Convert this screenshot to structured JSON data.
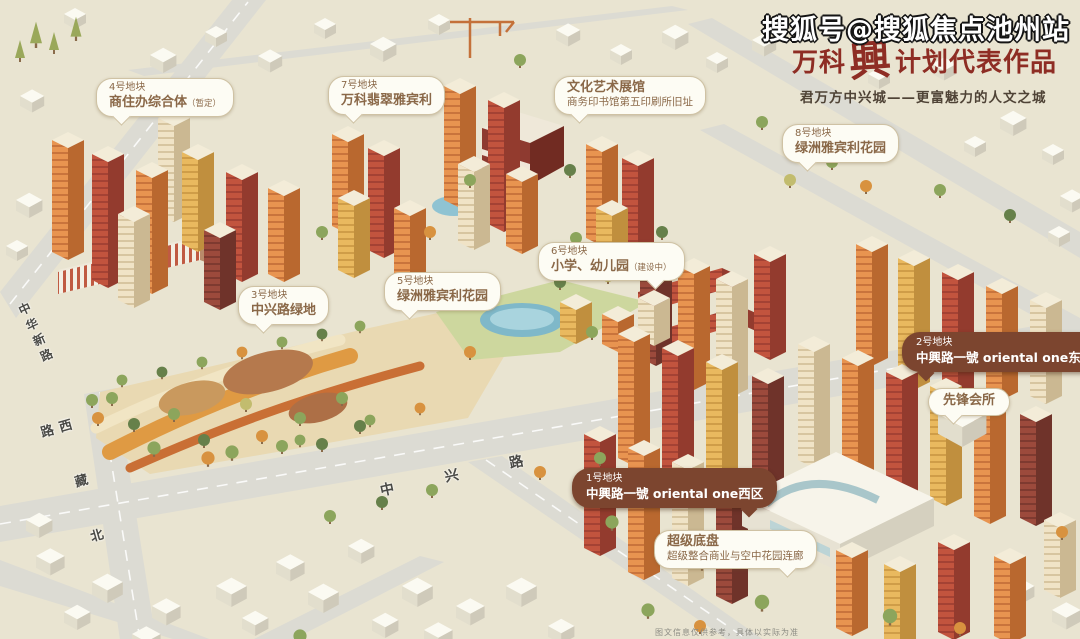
{
  "watermark": "搜狐号@搜狐焦点池州站",
  "header": {
    "title_prefix": "万科",
    "title_emphasis": "興",
    "title_suffix": "计划代表作品",
    "subtitle": "君万方中兴城——更富魅力的人文之城"
  },
  "callouts": [
    {
      "tag": "4号地块",
      "name": "商住办综合体",
      "suffix": "（暂定）"
    },
    {
      "tag": "7号地块",
      "name": "万科翡翠雅宾利"
    },
    {
      "name": "文化艺术展馆",
      "sub": "商务印书馆第五印刷所旧址"
    },
    {
      "tag": "8号地块",
      "name": "绿洲雅宾利花园"
    },
    {
      "tag": "6号地块",
      "name": "小学、幼儿园",
      "suffix": "（建设中）"
    },
    {
      "tag": "5号地块",
      "name": "绿洲雅宾利花园"
    },
    {
      "tag": "3号地块",
      "name": "中兴路绿地"
    },
    {
      "tag": "2号地块",
      "name": "中興路一號 oriental one东区"
    },
    {
      "name": "先锋会所"
    },
    {
      "tag": "1号地块",
      "name": "中興路一號 oriental one西区"
    },
    {
      "name": "超级底盘",
      "sub": "超级整合商业与空中花园连廊"
    }
  ],
  "roads": {
    "main": "中兴路",
    "west": "西藏北路",
    "northwest": "中华新路"
  },
  "footer": {
    "fineprint": "图文信息仅供参考，具体以实际为准"
  },
  "palette": {
    "background": "#e9e4d1",
    "road": "#dcdbd3",
    "title_red": "#8e2d24",
    "watermark": "#ffffff",
    "bubble_light_bg": "#fdfcf4",
    "bubble_light_text": "#8a6848",
    "bubble_dark_bg": "#7c452f",
    "bubble_dark_text": "#ffffff",
    "park_tan": "#e9d9b2",
    "path_orange": "#df9a43",
    "pond_blue": "#7fb8c9",
    "tower_orange": "#e89450",
    "tower_red": "#c2543e",
    "tower_yellow": "#e9b95f",
    "tower_cream": "#f0e3c6",
    "tower_maroon": "#9c4a3c"
  }
}
